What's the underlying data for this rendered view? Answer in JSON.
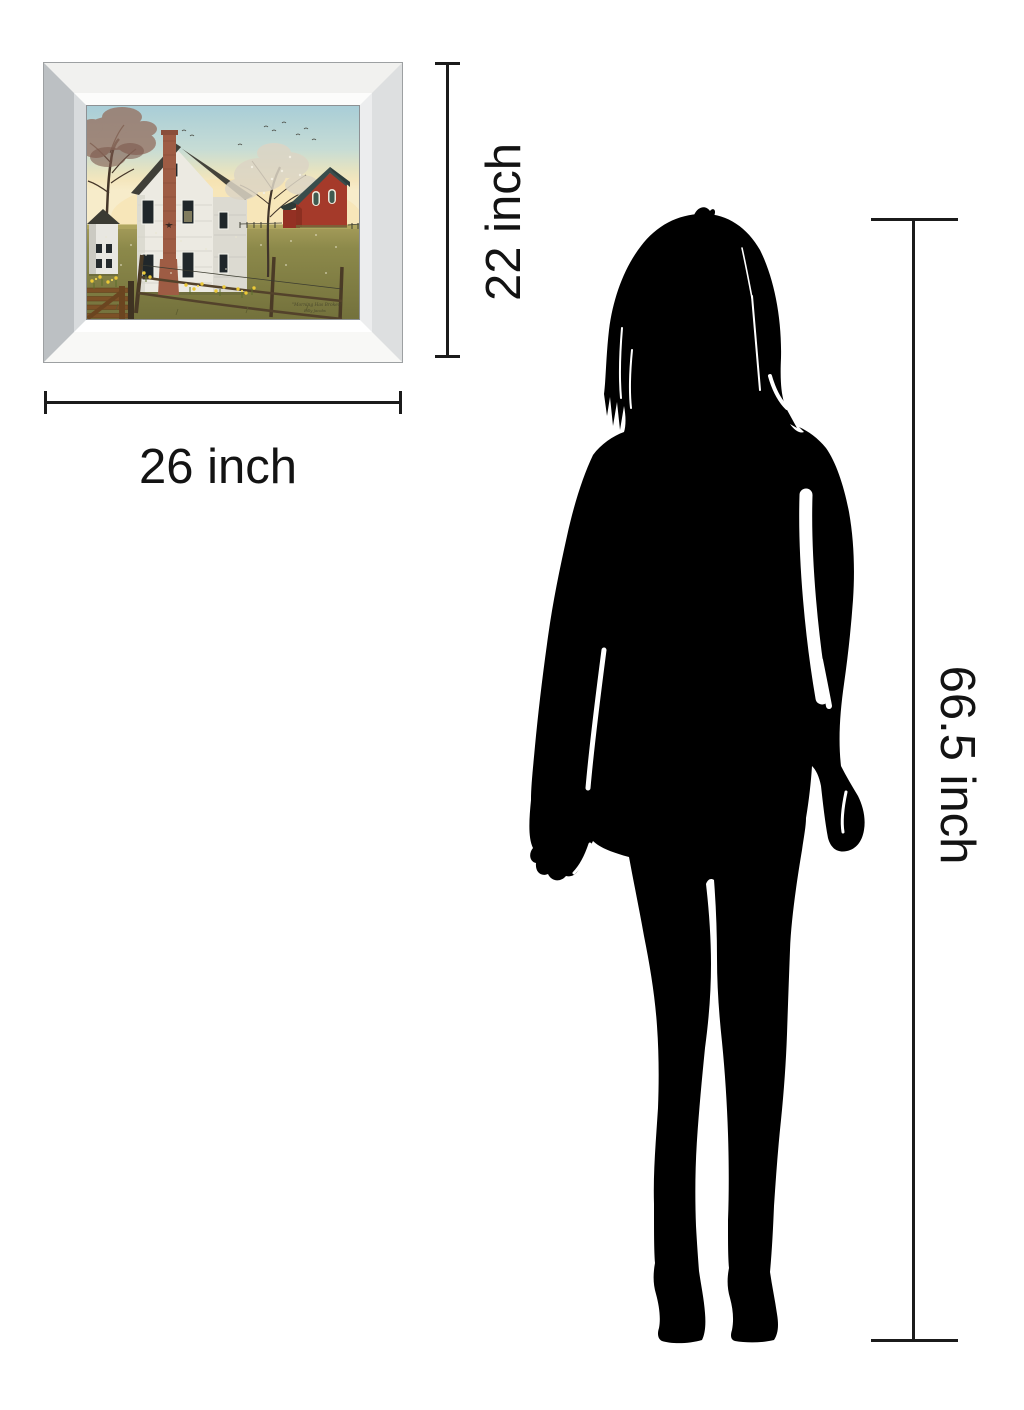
{
  "page": {
    "background": "#ffffff",
    "description": "product size comparison diagram"
  },
  "dimensions": {
    "artwork_height_label": "22 inch",
    "artwork_width_label": "26 inch",
    "person_height_label": "66.5 inch",
    "line_color": "#1b1b1b",
    "text_color": "#131313"
  },
  "frame": {
    "finish": "mirrored-silver-bevel",
    "outer_edge": "#9da0a2",
    "left_bevel": "#bcc0c3",
    "top_bevel": "#f1f1ef",
    "inner_highlight": "#ffffff"
  },
  "painting": {
    "signature_title": "\"Morning Has Broken\"",
    "signature_artist": "Billy Jacobs",
    "palette": {
      "sky_top": "#a8cdd7",
      "sky_horizon": "#f7ecca",
      "glow": "#f7dfa8",
      "grass": "#8c894a",
      "house_white": "#eceae2",
      "roof_gray": "#44433b",
      "chimney_brick": "#9e5c44",
      "barn_red": "#a53a2a",
      "barn_roof": "#3a4d4c",
      "daffodil_yellow": "#ecc937"
    }
  },
  "figure": {
    "type": "woman-silhouette",
    "color": "#000000"
  }
}
